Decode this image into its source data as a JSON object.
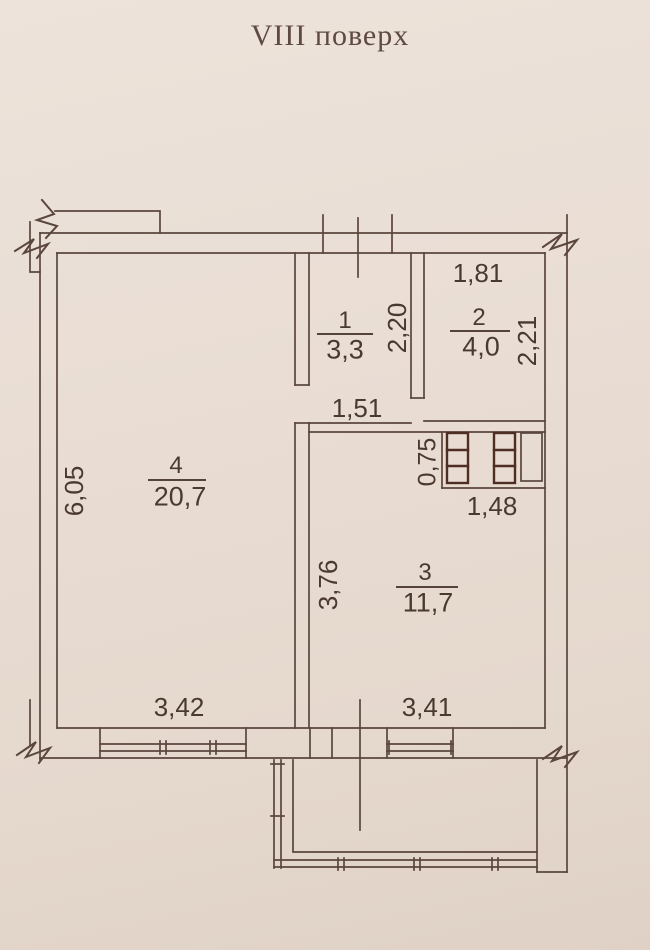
{
  "title": "VIII поверх",
  "plan": {
    "rooms": [
      {
        "number": "1",
        "area": "3,3",
        "width_dim": "1,51",
        "height_dim": "2,20"
      },
      {
        "number": "2",
        "area": "4,0",
        "width_dim": "1,81",
        "height_dim": "2,21"
      },
      {
        "number": "3",
        "area": "11,7",
        "width_dim": "3,41",
        "height_dim": "3,76"
      },
      {
        "number": "4",
        "area": "20,7",
        "width_dim": "3,42",
        "height_dim": "6,05"
      }
    ],
    "vent_shaft": {
      "width_dim": "1,48",
      "height_dim": "0,75"
    }
  },
  "colors": {
    "paper": "#e9ddd4",
    "line": "#5a463c",
    "text": "#49392f",
    "shaft_line": "#4e2d23"
  }
}
